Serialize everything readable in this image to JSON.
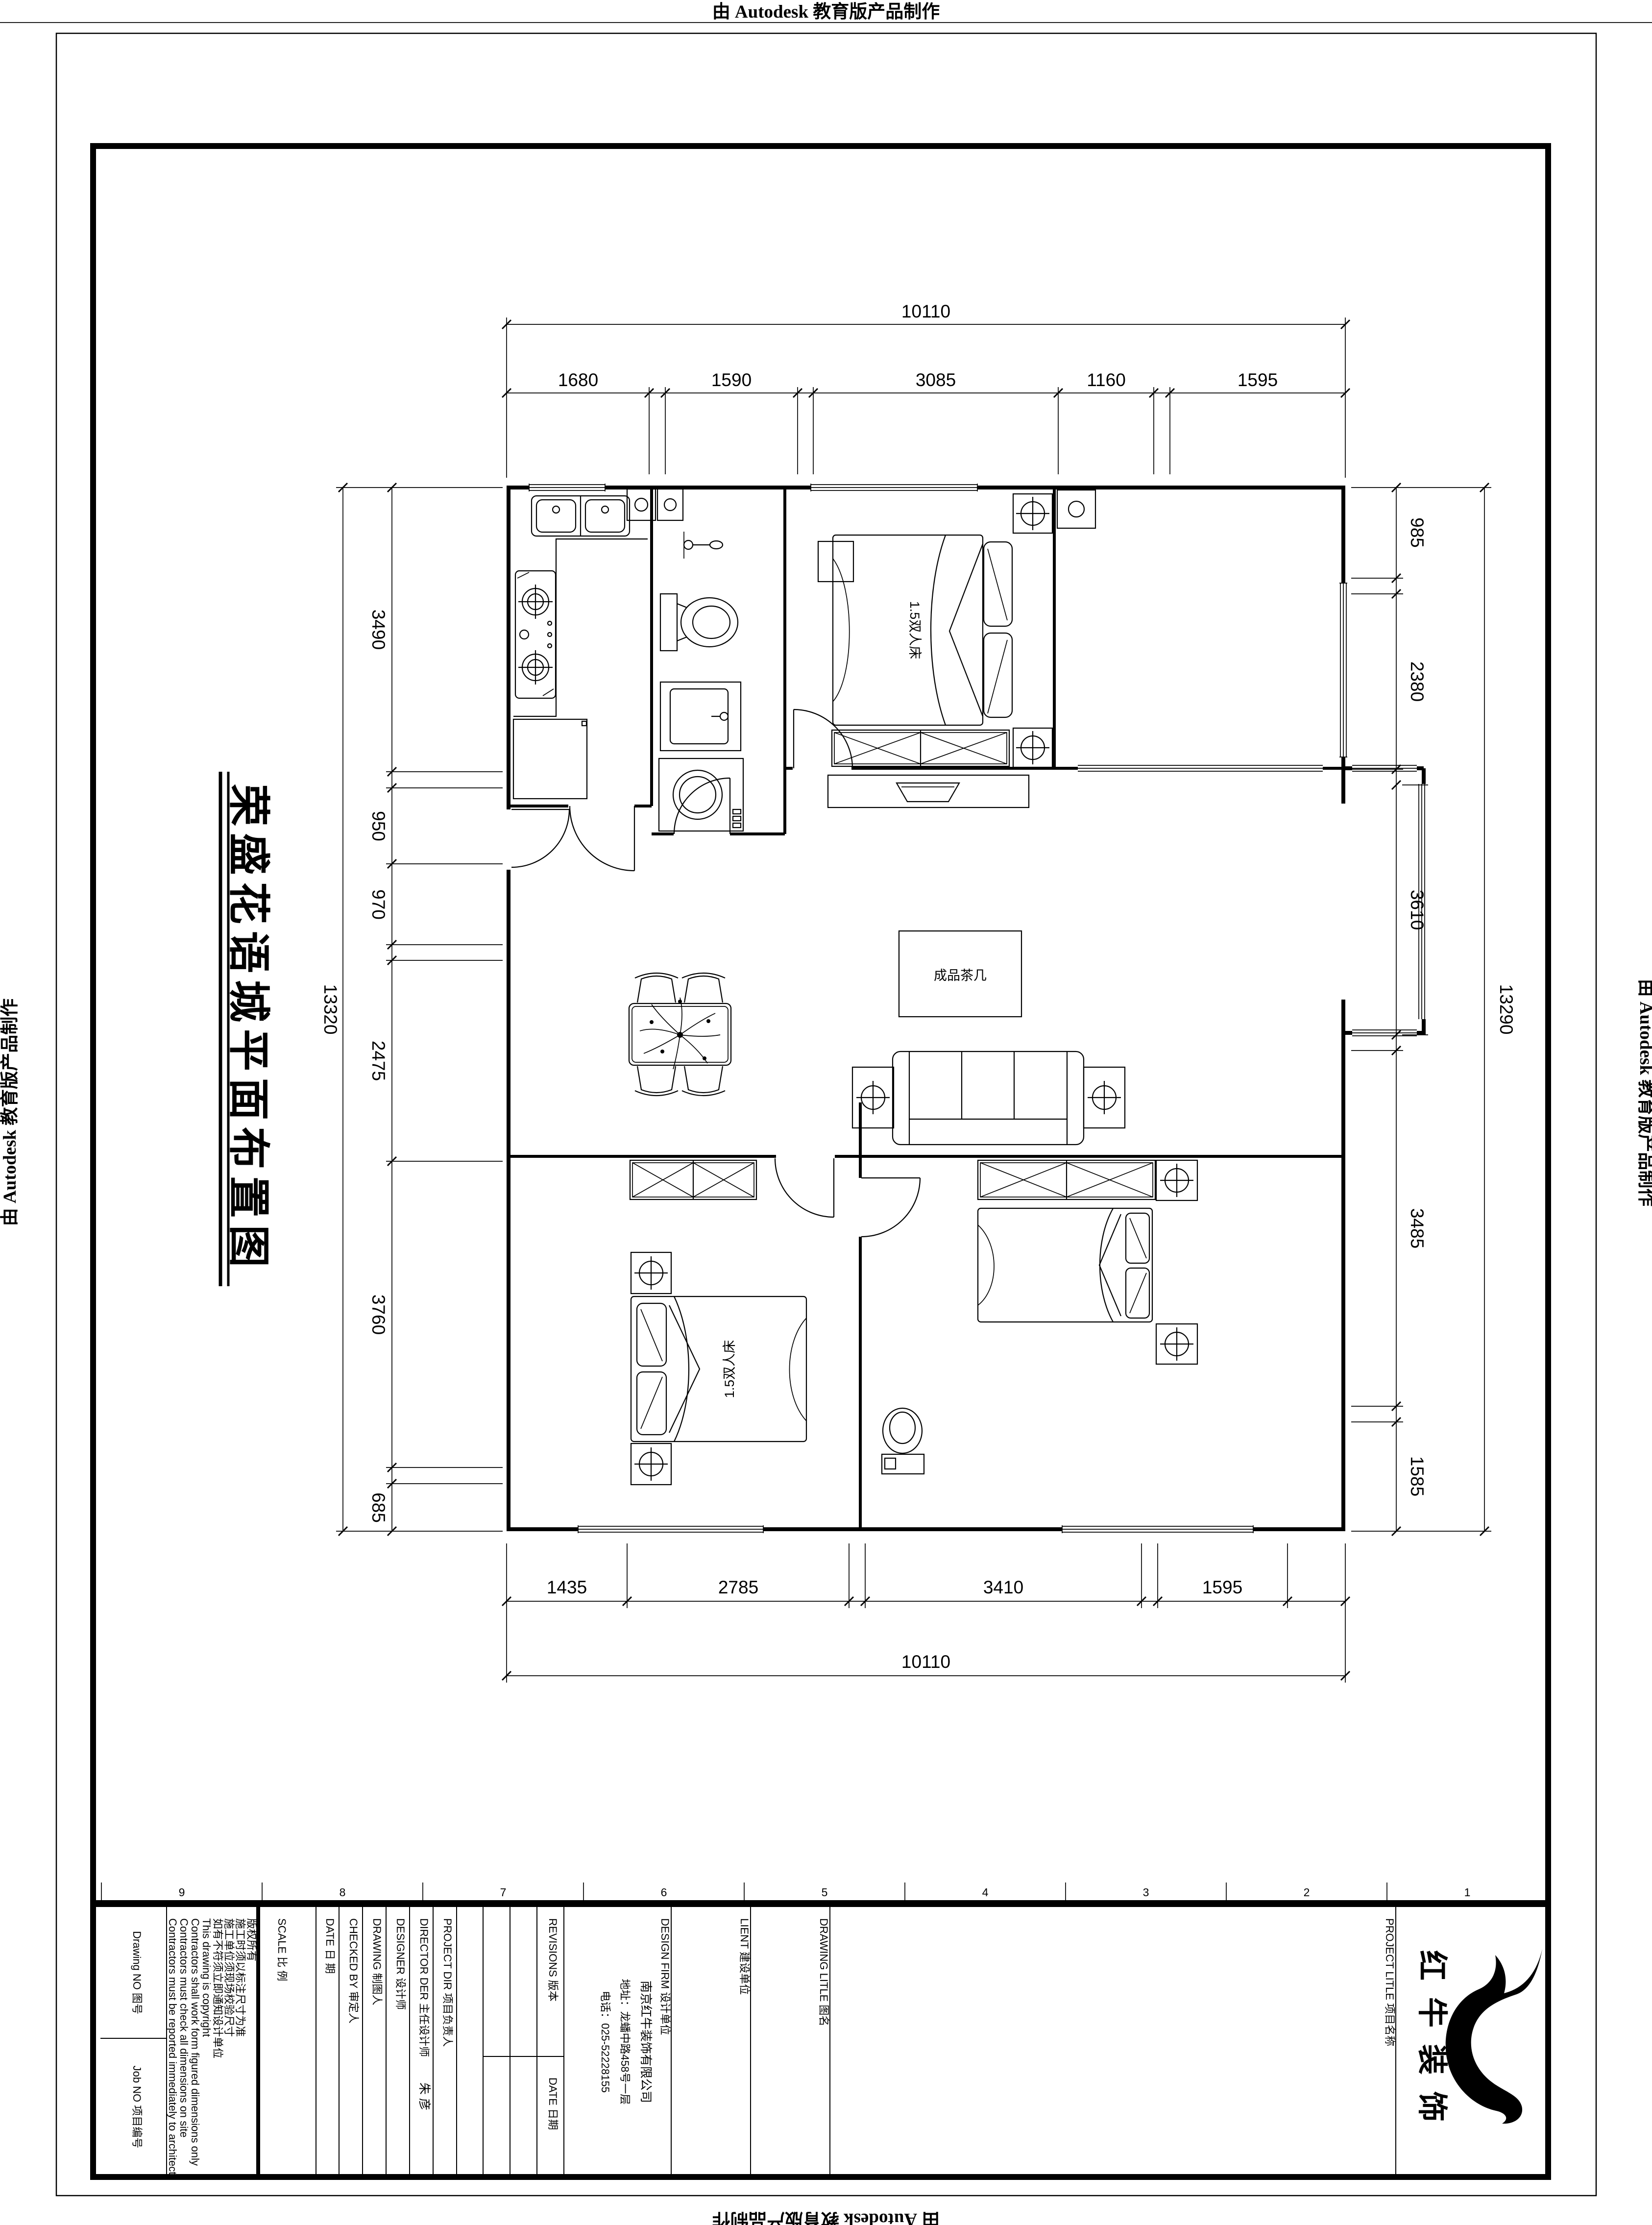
{
  "banners": {
    "top": "由 Autodesk 教育版产品制作",
    "bottom": "由 Autodesk 教育版产品制作",
    "left": "由 Autodesk 教育版产品制作",
    "right": "由 Autodesk 教育版产品制作"
  },
  "title_vertical": "荣盛花语城平面布置图",
  "dims": {
    "top": {
      "overall": "10110",
      "segments": [
        "1680",
        "1590",
        "3085",
        "1160",
        "1595"
      ]
    },
    "bottom": {
      "overall": "10110",
      "segments": [
        "1435",
        "2785",
        "3410",
        "1595"
      ]
    },
    "left": {
      "overall": "13320",
      "segments": [
        "3490",
        "950",
        "970",
        "2475",
        "3760",
        "685"
      ]
    },
    "right": {
      "overall": "13290",
      "segments": [
        "985",
        "2380",
        "3610",
        "3485",
        "1585"
      ]
    }
  },
  "labels": {
    "bed1": "1.5双人床",
    "bed2": "1.5双人床",
    "coffee_table": "成品茶几"
  },
  "zones": [
    "9",
    "8",
    "7",
    "6",
    "5",
    "4",
    "3",
    "2",
    "1"
  ],
  "tb": {
    "drawing_no": "Drawing NO 图号",
    "job_no": "Job NO 项目编号",
    "disclaimer": [
      "版权所有",
      "施工时须以标注尺寸为准",
      "施工单位须现场校验尺寸",
      "如有不符须立即通知设计单位",
      "This drawing is copyright",
      "Contractors shall work form figured dimensions only",
      "Contractors must check all dimensions on site",
      "Contractors must be reported immediately to architects"
    ],
    "scale": "SCALE 比 例",
    "date": "DATE 日 期",
    "checked": "CHECKED BY 审定人",
    "drawing": "DRAWING 制图人",
    "designer": "DESIGNER 设计师",
    "director": "DIRECTOR DER 主任设计师",
    "director_name": "朱 彦",
    "project_dir": "PROJECT DIR 项目负责人",
    "revisions": "REVISIONS 版本",
    "rev_date": "DATE 日期",
    "firm_label": "DESIGN FIRM 设计单位",
    "firm": [
      "南京红牛装饰有限公司",
      "地址：龙蟠中路458号一层",
      "电话：025-52228155"
    ],
    "client": "LIENT 建设单位",
    "drawing_title": "DRAWING LITLE 图名",
    "project_title": "PROJECT LITLE 项目名称",
    "logo_text": "红牛装饰"
  }
}
